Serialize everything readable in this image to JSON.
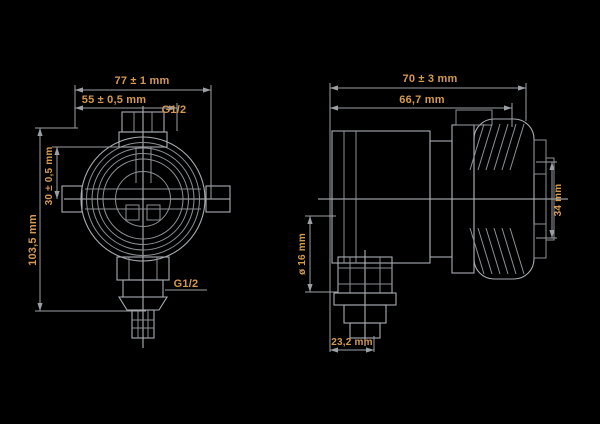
{
  "drawing": {
    "type": "technical-dimension-drawing",
    "colors": {
      "background": "#000000",
      "line": "#a9adb2",
      "dimension_text": "#d69a4f"
    },
    "labels": {
      "dim_width_total": "77 ± 1 mm",
      "dim_width_body": "55 ± 0,5 mm",
      "thread_top": "G1/2",
      "thread_bottom": "G1/2",
      "dim_height_total": "103,5 mm",
      "dim_center_offset": "30 ± 0,5 mm",
      "dim_depth_total": "70 ± 3 mm",
      "dim_depth_body": "66,7 mm",
      "dim_port_diameter": "ø 16 mm",
      "dim_side_height": "34 mm",
      "dim_bottom_offset": "23,2 mm"
    }
  }
}
